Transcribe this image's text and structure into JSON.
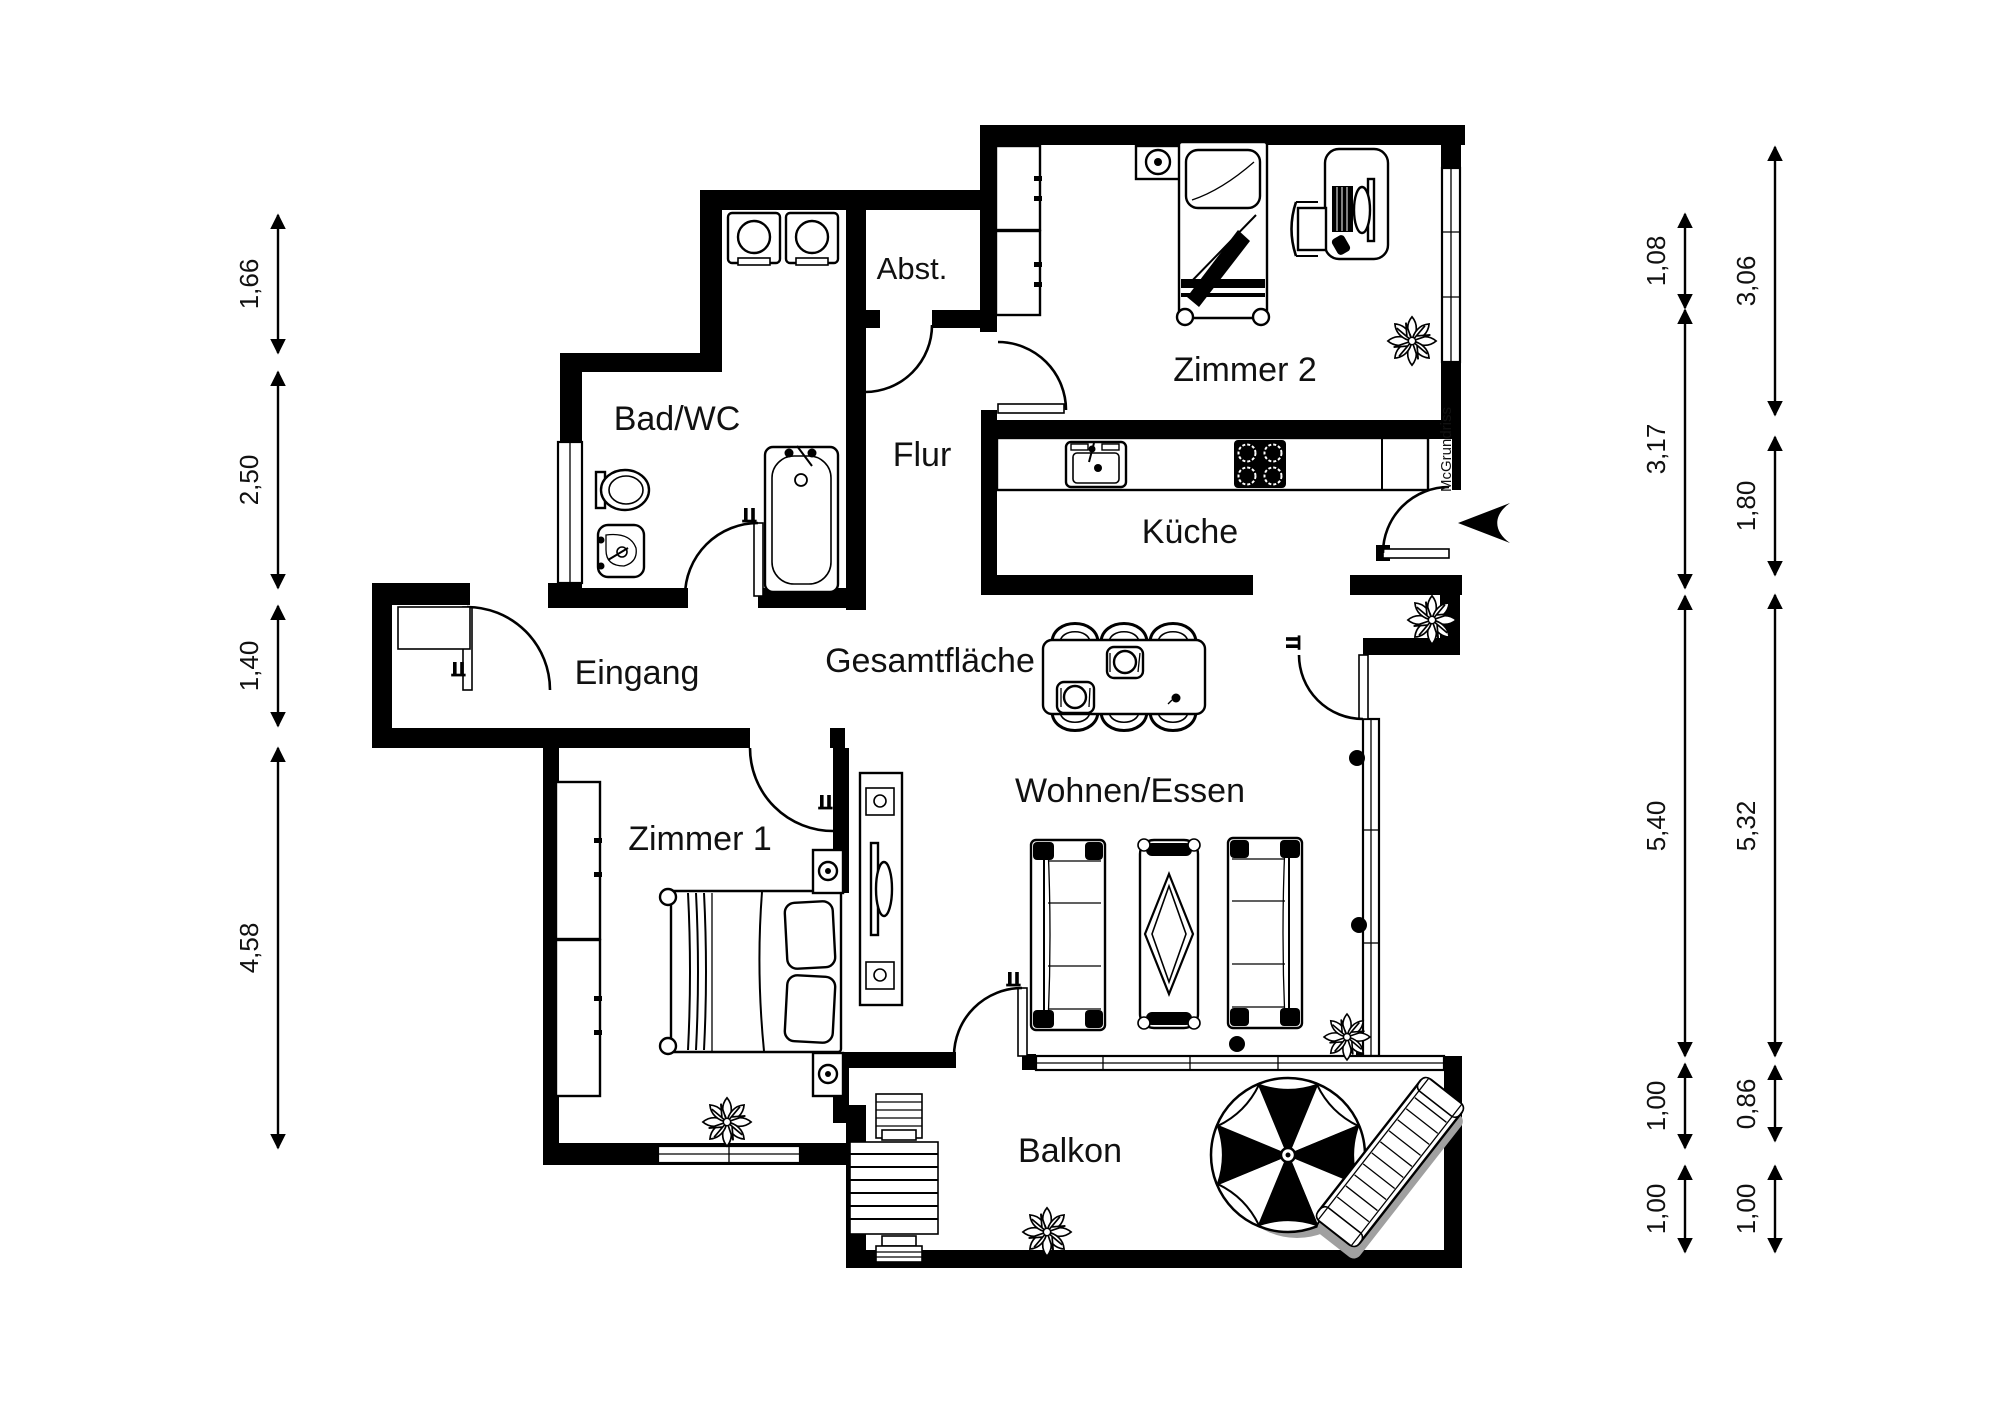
{
  "rooms": {
    "abst": "Abst.",
    "zimmer2": "Zimmer 2",
    "bad": "Bad/WC",
    "flur": "Flur",
    "kueche": "Küche",
    "eingang": "Eingang",
    "gesamtflaeche": "Gesamtfläche",
    "wohnen": "Wohnen/Essen",
    "zimmer1": "Zimmer 1",
    "balkon": "Balkon"
  },
  "watermark": "McGrundriss",
  "dims": {
    "left": [
      "1,66",
      "2,50",
      "1,40",
      "4,58"
    ],
    "inner": [
      "1,08",
      "3,17",
      "5,40",
      "1,00",
      "1,00"
    ],
    "outer": [
      "3,06",
      "1,80",
      "5,32",
      "0,86",
      "1,00"
    ]
  },
  "colors": {
    "wall": "#000000",
    "background": "#ffffff",
    "shadow": "#a0a0a0",
    "text": "#111111"
  }
}
